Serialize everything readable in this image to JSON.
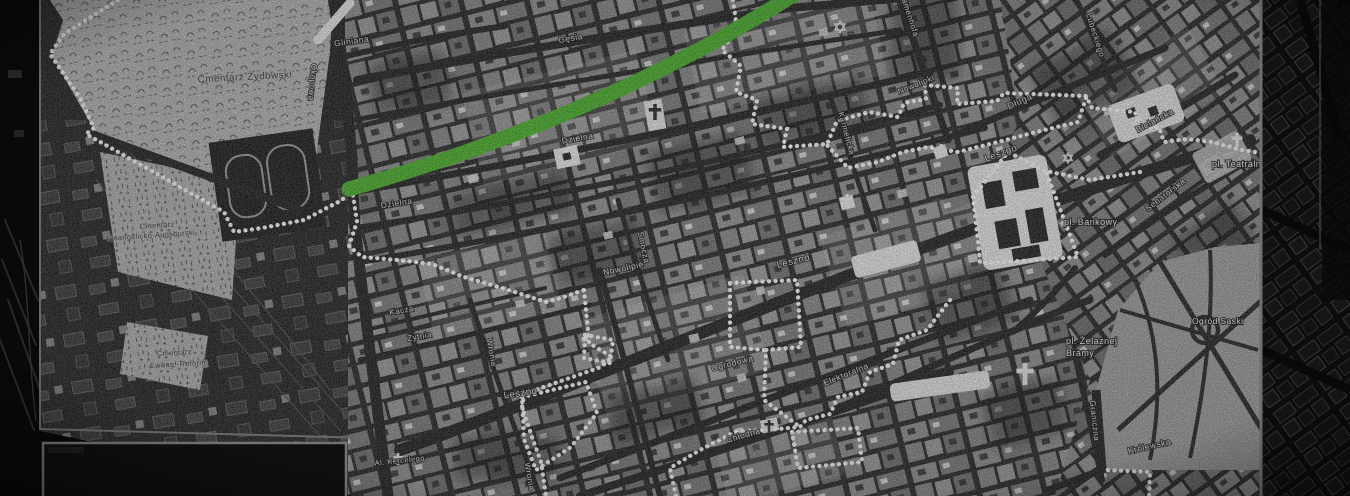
{
  "map": {
    "route_color": "#3fae1e",
    "boundary_color": "#ffffff",
    "labels": [
      {
        "kind": "street",
        "text": "Gliniana",
        "x": 352,
        "y": 44,
        "r": -8,
        "s": 8.5
      },
      {
        "kind": "street",
        "text": "Gęsia",
        "x": 571,
        "y": 41,
        "r": -10,
        "s": 8.5
      },
      {
        "kind": "street",
        "text": "Okopowa",
        "x": 310,
        "y": 82,
        "r": 95,
        "s": 8
      },
      {
        "kind": "street",
        "text": "Zamenhofa",
        "x": 907,
        "y": 16,
        "r": 72,
        "s": 8
      },
      {
        "kind": "street",
        "text": "Lubeckiego",
        "x": 1093,
        "y": 36,
        "r": 72,
        "s": 8
      },
      {
        "kind": "street",
        "text": "Dzielna",
        "x": 578,
        "y": 141,
        "r": -10,
        "s": 8.5
      },
      {
        "kind": "street",
        "text": "Dzielna",
        "x": 397,
        "y": 206,
        "r": -9,
        "s": 8.5
      },
      {
        "kind": "street",
        "text": "Smocza",
        "x": 641,
        "y": 248,
        "r": 78,
        "s": 8
      },
      {
        "kind": "street",
        "text": "Nowolipki",
        "x": 917,
        "y": 87,
        "r": -22,
        "s": 8
      },
      {
        "kind": "street",
        "text": "Karmelicka",
        "x": 844,
        "y": 134,
        "r": 75,
        "s": 8
      },
      {
        "kind": "street",
        "text": "Nowolipie",
        "x": 624,
        "y": 271,
        "r": -12,
        "s": 8.5
      },
      {
        "kind": "street",
        "text": "Długa",
        "x": 1021,
        "y": 104,
        "r": -24,
        "s": 9
      },
      {
        "kind": "street",
        "text": "Leszno",
        "x": 1002,
        "y": 156,
        "r": -20,
        "s": 9.5
      },
      {
        "kind": "street",
        "text": "Leszno",
        "x": 794,
        "y": 264,
        "r": -14,
        "s": 9.5
      },
      {
        "kind": "street",
        "text": "Leszno",
        "x": 521,
        "y": 396,
        "r": -9,
        "s": 9.5
      },
      {
        "kind": "street",
        "text": "Żytnia",
        "x": 420,
        "y": 339,
        "r": -10,
        "s": 8
      },
      {
        "kind": "street",
        "text": "Kacza",
        "x": 402,
        "y": 313,
        "r": -10,
        "s": 8
      },
      {
        "kind": "street",
        "text": "Wronia",
        "x": 489,
        "y": 353,
        "r": 80,
        "s": 8
      },
      {
        "kind": "street",
        "text": "Wronia",
        "x": 527,
        "y": 477,
        "r": 80,
        "s": 8
      },
      {
        "kind": "street",
        "text": "Ogrodowa",
        "x": 733,
        "y": 366,
        "r": -14,
        "s": 8.5
      },
      {
        "kind": "street",
        "text": "Chłodna",
        "x": 744,
        "y": 438,
        "r": -16,
        "s": 8.5
      },
      {
        "kind": "street",
        "text": "Elektoralna",
        "x": 847,
        "y": 377,
        "r": -22,
        "s": 8.5
      },
      {
        "kind": "street",
        "text": "Graniczna",
        "x": 1092,
        "y": 421,
        "r": 84,
        "s": 8
      },
      {
        "kind": "street",
        "text": "Królewska",
        "x": 1150,
        "y": 449,
        "r": -13,
        "s": 8.5
      },
      {
        "kind": "street",
        "text": "Senatorska",
        "x": 1167,
        "y": 197,
        "r": -38,
        "s": 8.5
      },
      {
        "kind": "street",
        "text": "Bielańska",
        "x": 1156,
        "y": 123,
        "r": -28,
        "s": 8.5
      },
      {
        "kind": "street",
        "text": "Al. Kercelego",
        "x": 400,
        "y": 463,
        "r": -6,
        "s": 7.5
      },
      {
        "kind": "place",
        "text": "pl. Bankowy",
        "x": 1064,
        "y": 225,
        "r": 0,
        "s": 9,
        "anchor": "start"
      },
      {
        "kind": "place",
        "text": "pl. Teatralny",
        "x": 1212,
        "y": 167,
        "r": 0,
        "s": 9,
        "anchor": "start"
      },
      {
        "kind": "place",
        "text": "pl. Żelaznej",
        "x": 1066,
        "y": 344,
        "r": 0,
        "s": 9,
        "anchor": "start"
      },
      {
        "kind": "place",
        "text": "Bramy",
        "x": 1066,
        "y": 356,
        "r": 0,
        "s": 9,
        "anchor": "start"
      },
      {
        "kind": "place",
        "text": "Ogród Saski",
        "x": 1192,
        "y": 324,
        "r": 0,
        "s": 8.5,
        "anchor": "start"
      },
      {
        "kind": "cem",
        "text": "Cmentarz Żydowski",
        "x": 245,
        "y": 80,
        "r": -3,
        "s": 10
      },
      {
        "kind": "cem",
        "text": "Cmentarz",
        "x": 140,
        "y": 229,
        "r": -4,
        "s": 7.5,
        "anchor": "start"
      },
      {
        "kind": "cem",
        "text": "Ewangelicko-Augsburski",
        "x": 107,
        "y": 241,
        "r": -4,
        "s": 7.5,
        "anchor": "start"
      },
      {
        "kind": "cem",
        "text": "Cmentarz",
        "x": 157,
        "y": 356,
        "r": -3,
        "s": 7.5,
        "anchor": "start"
      },
      {
        "kind": "cem",
        "text": "Ewang.-Reform.",
        "x": 150,
        "y": 368,
        "r": -3,
        "s": 7.5,
        "anchor": "start"
      }
    ],
    "icons": [
      {
        "type": "star-of-david",
        "x": 840,
        "y": 27,
        "size": 6,
        "color": "#e8e8e8"
      },
      {
        "type": "star-of-david",
        "x": 1068,
        "y": 158,
        "size": 5,
        "color": "#dcdcdc"
      },
      {
        "type": "cross",
        "x": 655,
        "y": 112,
        "size": 8,
        "color": "#1b1b1b"
      },
      {
        "type": "cross",
        "x": 847,
        "y": 201,
        "size": 7,
        "color": "#f0f0f0"
      },
      {
        "type": "cross",
        "x": 941,
        "y": 151,
        "size": 7,
        "color": "#f0f0f0"
      },
      {
        "type": "cross",
        "x": 1237,
        "y": 140,
        "size": 7,
        "color": "#f0f0f0"
      },
      {
        "type": "cross",
        "x": 769,
        "y": 426,
        "size": 6,
        "color": "#1b1b1b"
      },
      {
        "type": "cross",
        "x": 1025,
        "y": 374,
        "size": 11,
        "color": "#ededed"
      },
      {
        "type": "cross",
        "x": 398,
        "y": 459,
        "size": 6,
        "color": "#f0f0f0"
      }
    ]
  }
}
